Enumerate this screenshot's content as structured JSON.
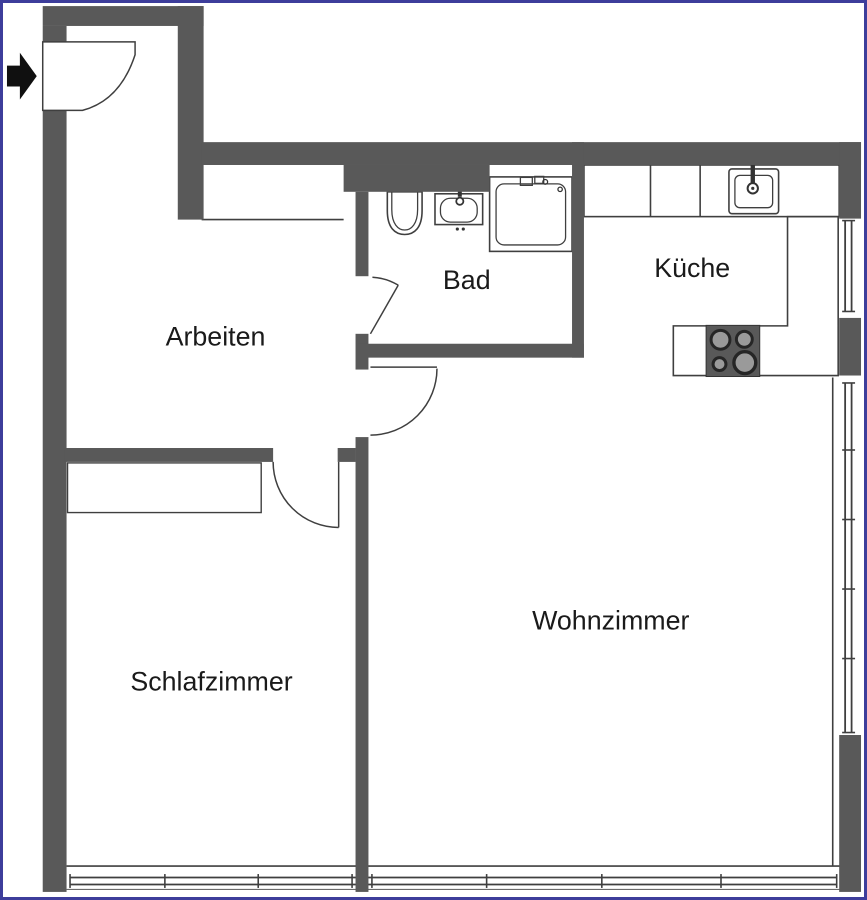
{
  "floorplan": {
    "rooms": [
      {
        "name": "arbeiten",
        "label": "Arbeiten"
      },
      {
        "name": "bad",
        "label": "Bad"
      },
      {
        "name": "kueche",
        "label": "Küche"
      },
      {
        "name": "schlafzimmer",
        "label": "Schlafzimmer"
      },
      {
        "name": "wohnzimmer",
        "label": "Wohnzimmer"
      }
    ],
    "fixtures": [
      "entrance-arrow",
      "entrance-door",
      "toilet",
      "bathroom-sink",
      "shower",
      "kitchen-sink",
      "stove",
      "wardrobe",
      "windows"
    ],
    "colors": {
      "wall": "#595959",
      "line": "#3f3f3f",
      "border": "#3d3d9b",
      "label": "#1a1a1a",
      "burner": "#9a9a9a"
    }
  }
}
